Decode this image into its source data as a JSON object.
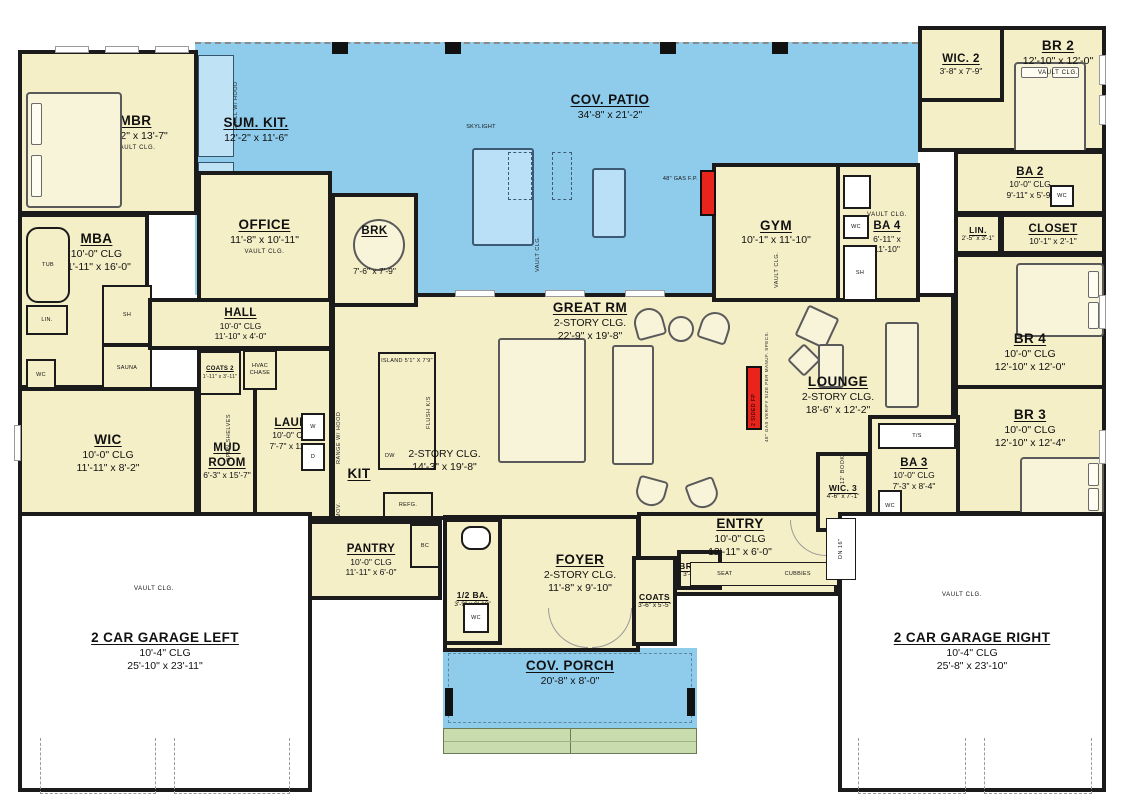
{
  "colors": {
    "wall": "#1b1b1b",
    "floor": "#f5efc8",
    "patio": "#8fccec",
    "steps": "#c8dcae",
    "fireplace": "#e8241c",
    "garage": "#ffffff"
  },
  "rooms": {
    "mbr": {
      "name": "MBR",
      "dims": "16'-2\" x 13'-7\"",
      "note": "VAULT CLG."
    },
    "sum_kit": {
      "name": "SUM. KIT.",
      "dims": "12'-2\" x 11'-6\""
    },
    "cov_patio": {
      "name": "COV. PATIO",
      "dims": "34'-8\" x 21'-2\""
    },
    "office": {
      "name": "OFFICE",
      "dims": "11'-8\" x 10'-11\"",
      "note": "VAULT CLG."
    },
    "brk": {
      "name": "BRK",
      "dims": "7'-6\" x 7'-9\""
    },
    "gym": {
      "name": "GYM",
      "dims": "10'-1\" x 11'-10\""
    },
    "ba4": {
      "name": "BA 4",
      "dims": "6'-11\" x 11'-10\"",
      "note": "VAULT CLG."
    },
    "wic2": {
      "name": "WIC. 2",
      "dims": "3'-8\" x 7'-9\""
    },
    "br2": {
      "name": "BR 2",
      "dims": "12'-10\" x 12'-0\"",
      "note": "VAULT CLG."
    },
    "ba2": {
      "name": "BA 2",
      "clg": "10'-0\" CLG",
      "dims": "9'-11\" x 5'-9\""
    },
    "lin2": {
      "name": "LIN.",
      "dims": "2'-5\" x 3'-1\""
    },
    "closet": {
      "name": "CLOSET",
      "dims": "10'-1\" x 2'-1\""
    },
    "mba": {
      "name": "MBA",
      "clg": "10'-0\" CLG",
      "dims": "11'-11\" x 16'-0\""
    },
    "hall": {
      "name": "HALL",
      "clg": "10'-0\" CLG",
      "dims": "11'-10\" x 4'-0\""
    },
    "wic": {
      "name": "WIC",
      "clg": "10'-0\" CLG",
      "dims": "11'-11\" x 8'-2\""
    },
    "mud": {
      "name": "MUD ROOM",
      "dims": "6'-3\" x 15'-7\""
    },
    "coats2": {
      "name": "COATS 2",
      "dims": "1'-11\" x 3'-11\""
    },
    "laun": {
      "name": "LAUN.",
      "clg": "10'-0\" CLG",
      "dims": "7'-7\" x 11'-3\""
    },
    "kit": {
      "name": "KIT",
      "clg": "2-STORY CLG.",
      "dims": "14'-3\" x 19'-8\""
    },
    "great": {
      "name": "GREAT RM",
      "clg": "2-STORY CLG.",
      "dims": "22'-9\" x 19'-8\""
    },
    "lounge": {
      "name": "LOUNGE",
      "clg": "2-STORY CLG.",
      "dims": "18'-6\" x 12'-2\""
    },
    "br4": {
      "name": "BR 4",
      "clg": "10'-0\" CLG",
      "dims": "12'-10\" x 12'-0\""
    },
    "br3": {
      "name": "BR 3",
      "clg": "10'-0\" CLG",
      "dims": "12'-10\" x 12'-4\""
    },
    "ba3": {
      "name": "BA 3",
      "clg": "10'-0\" CLG",
      "dims": "7'-3\" x 8'-4\""
    },
    "wic3": {
      "name": "WIC. 3",
      "dims": "4'-6\" x 7'-1\""
    },
    "pantry": {
      "name": "PANTRY",
      "clg": "10'-0\" CLG",
      "dims": "11'-11\" x 6'-0\""
    },
    "halfba": {
      "name": "1/2 BA.",
      "dims": "3'-9\" x 9'-10\""
    },
    "foyer": {
      "name": "FOYER",
      "clg": "2-STORY CLG.",
      "dims": "11'-8\" x 9'-10\""
    },
    "entry": {
      "name": "ENTRY",
      "clg": "10'-0\" CLG",
      "dims": "12'-11\" x 6'-0\""
    },
    "coats": {
      "name": "COATS",
      "dims": "3'-6\" x 5'-5\""
    },
    "brooms": {
      "name": "BROOMS",
      "dims": "3'-4\" x 1'-7\""
    },
    "porch": {
      "name": "COV. PORCH",
      "dims": "20'-8\" x 8'-0\""
    },
    "gar_l": {
      "name": "2 CAR GARAGE LEFT",
      "clg": "10'-4\" CLG",
      "dims": "25'-10\" x 23'-11\""
    },
    "gar_r": {
      "name": "2 CAR GARAGE RIGHT",
      "clg": "10'-4\" CLG",
      "dims": "25'-8\" x 23'-10\""
    }
  },
  "small": {
    "vault": "VAULT CLG.",
    "skylight": "SKYLIGHT",
    "grill": "GRILL W/ HOOD",
    "gasfp": "48\" GAS F.P.",
    "tub": "TUB",
    "lin": "LIN.",
    "wc": "WC",
    "sh": "SH",
    "sauna": "SAUNA",
    "hvac": "HVAC CHASE",
    "shelves": "OPEN SHELVES",
    "washer": "W",
    "dryer": "D",
    "dw": "DW",
    "refg": "REFG.",
    "mov": "MOV.",
    "island": "ISLAND 5'1\" X 7'9\"",
    "range": "RANGE W/ HOOD",
    "flush": "FLUSH K/S",
    "bc": "BC",
    "seat": "SEAT",
    "cubbies": "CUBBIES",
    "ts": "T/S",
    "books": "12' BOOKS",
    "fp2": "2 SIDED FP",
    "fp2note": "48\" GAS VERIFY SIZE PER MANUF. SPECS.",
    "dn": "DN 16\""
  }
}
